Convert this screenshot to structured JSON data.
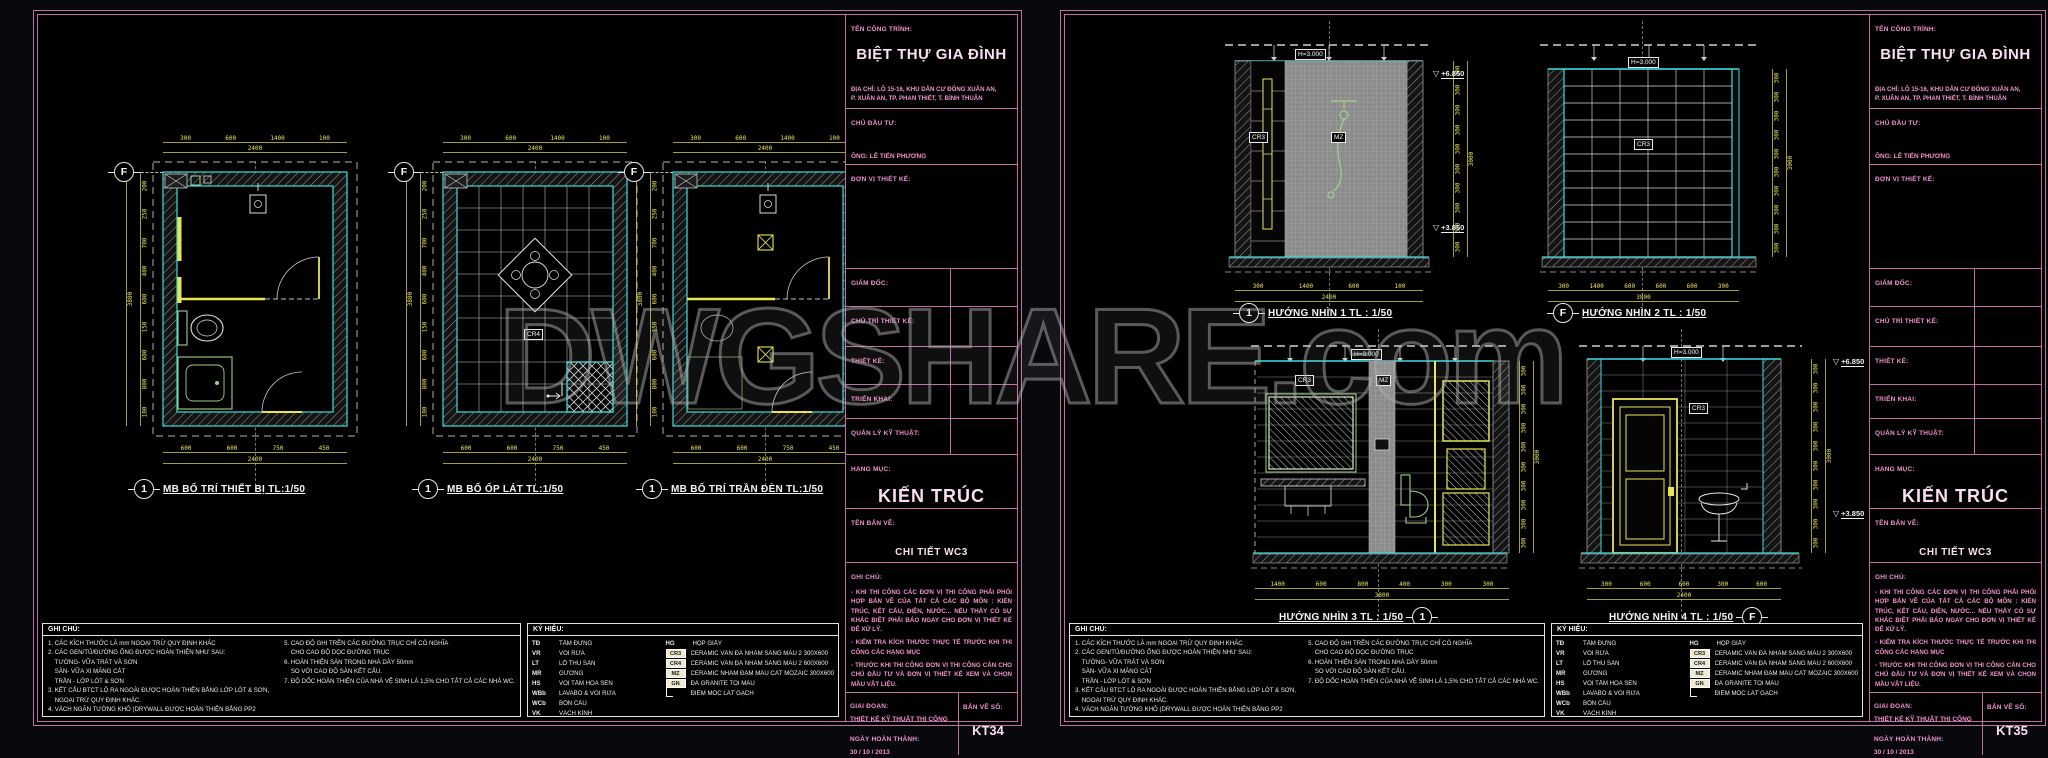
{
  "watermark": {
    "text": "DWGSHARE.com"
  },
  "grid": {
    "f": "F",
    "one": "1"
  },
  "tags": {
    "cr3": "CR3",
    "cr4": "CR4",
    "mz": "MZ",
    "h": "H=3.000"
  },
  "levels": {
    "upper": "+6.850",
    "lower": "+3.850"
  },
  "left_sheet": {
    "plans": [
      {
        "title": "MB BỐ TRÍ THIẾT BỊ TL:1/50"
      },
      {
        "title": "MB BỐ ỐP LÁT TL:1/50"
      },
      {
        "title": "MB BỐ TRÍ TRẦN ĐÈN TL:1/50"
      }
    ],
    "plan_dims": {
      "top": [
        "300",
        "600",
        "1400",
        "100"
      ],
      "top_total": "2400",
      "left": [
        "200",
        "250",
        "700",
        "400",
        "600",
        "150",
        "600",
        "800",
        "100"
      ],
      "left_total": "3800",
      "bottom": [
        "600",
        "600",
        "750",
        "450"
      ],
      "bottom_total": "2400"
    }
  },
  "right_sheet": {
    "elevations": [
      {
        "title": "HƯỚNG NHÌN 1 TL : 1/50",
        "bubble": "1"
      },
      {
        "title": "HƯỚNG NHÌN 2 TL : 1/50",
        "bubble": "F"
      },
      {
        "title": "HƯỚNG NHÌN 3 TL : 1/50",
        "bubble": "1"
      },
      {
        "title": "HƯỚNG NHÌN 4 TL : 1/50",
        "bubble": "F"
      }
    ],
    "elev_dims": {
      "side": [
        "300",
        "300",
        "300",
        "300",
        "300",
        "300",
        "300",
        "300",
        "300",
        "300"
      ],
      "side_total": "3000",
      "e1_bottom": [
        "300",
        "1400",
        "600",
        "100"
      ],
      "e1_total": "2400",
      "e2_bottom": [
        "300",
        "1400",
        "600",
        "600",
        "600",
        "300"
      ],
      "e2_total": "3800",
      "e3_bottom": [
        "1400",
        "600",
        "800",
        "400",
        "300",
        "300"
      ],
      "e3_total": "3800",
      "e4_bottom": [
        "300",
        "600",
        "600",
        "300",
        "600"
      ],
      "e4_total": "2400"
    }
  },
  "tb": {
    "project_label": "TÊN CÔNG TRÌNH:",
    "project_name": "BIỆT THỰ GIA ĐÌNH",
    "address_line1": "ĐỊA CHỈ: LÔ 15-16, KHU DÂN CƯ ĐỒNG XUÂN AN,",
    "address_line2": "P. XUÂN AN, TP. PHAN THIẾT, T. BÌNH THUẬN",
    "investor_label": "CHỦ ĐẦU TƯ:",
    "investor_name": "ÔNG: LÊ TIẾN PHƯƠNG",
    "design_unit_label": "ĐƠN VỊ THIẾT KẾ:",
    "director_label": "GIÁM ĐỐC:",
    "design_lead_label": "CHỦ TRÌ THIẾT KẾ:",
    "designer_label": "THIẾT KẾ:",
    "develop_label": "TRIỂN KHAI:",
    "tech_mgr_label": "QUẢN LÝ KỸ THUẬT:",
    "category_label": "HẠNG MỤC:",
    "category": "KIẾN TRÚC",
    "drawing_name_label": "TÊN BẢN VẼ:",
    "drawing_name": "CHI TIẾT WC3",
    "notes_label": "GHI CHÚ:",
    "note1": "- KHI THI CÔNG CÁC ĐƠN VỊ THI CÔNG PHẢI PHỐI HỢP BẢN VẼ CỦA TẤT CẢ CÁC BỘ MÔN : KIẾN TRÚC, KẾT CẤU, ĐIỆN, NƯỚC... NẾU THẤY CÓ SỰ KHÁC BIỆT PHẢI BÁO NGAY CHO ĐƠN VỊ THIẾT KẾ ĐỂ XỬ LÝ.",
    "note2": "- KIỂM TRA KÍCH THƯỚC THỰC TẾ TRƯỚC KHI THI CÔNG CÁC HẠNG MỤC",
    "note3": "- TRƯỚC KHI THI CÔNG ĐƠN VỊ THI CÔNG CẦN CHO CHỦ ĐẦU TƯ VÀ ĐƠN VỊ THIẾT KẾ XEM VÀ CHỌN MẪU VẬT LIỆU.",
    "phase_label": "GIAI ĐOẠN:",
    "phase": "THIẾT KẾ KỸ THUẬT THI CÔNG",
    "date_label": "NGÀY HOÀN THÀNH:",
    "date": "30 / 10 / 2013",
    "sheet_no_label": "BẢN VẼ SỐ:",
    "sheet_no_left": "KT34",
    "sheet_no_right": "KT35"
  },
  "bottom_notes": {
    "header": "GHI CHÚ:",
    "col1": [
      "1.  CÁC KÍCH THƯỚC LÀ mm NGOẠI TRỪ QUY ĐỊNH KHÁC",
      "2.  CÁC GEN/TỦ/ĐƯỜNG ỐNG ĐƯỢC HOÀN THIỆN NHƯ SAU:",
      "    TƯỜNG-   VỮA TRÁT VÀ SƠN",
      "    SÀN-  VỮA XI MĂNG CÁT",
      "    TRẦN - LỚP LÓT & SƠN",
      "3.  KẾT CẤU BTCT LỘ RA NGOÀI ĐƯỢC HOÀN THIỆN BẰNG LỚP LÓT & SƠN,",
      "    NGOẠI TRỪ QUY ĐỊNH KHÁC.",
      "4.  VÁCH NGĂN TƯỜNG KHÔ (DRYWALL ĐƯỢC HOÀN THIỆN BẰNG  PP2"
    ],
    "col2": [
      "5.  CAO ĐỘ GHI TRÊN CÁC ĐƯỜNG TRỤC CHỈ CÓ NGHĨA",
      "    CHO CAO ĐỘ  DỌC ĐƯỜNG TRỤC",
      "6.  HOÀN THIỆN SÀN TRONG NHÀ DÀY 50mm",
      "    SO VỚI CAO ĐỘ  SÀN KẾT CẤU.",
      "7.  ĐỘ DỐC HOÀN THIỆN CỦA NHÀ VỆ SINH LÀ 1,5% CHO TẤT CẢ CÁC NHÀ WC."
    ],
    "legend_header": "KÝ HIỆU:",
    "legend_left": [
      {
        "code": "TĐ",
        "name": "TẤM ĐỨNG"
      },
      {
        "code": "VR",
        "name": "VÒI RỬA"
      },
      {
        "code": "LT",
        "name": "LỖ THU SÀN"
      },
      {
        "code": "MR",
        "name": "GƯƠNG"
      },
      {
        "code": "HS",
        "name": "VÒI TẮM HOA SEN"
      },
      {
        "code": "WBb",
        "name": "LAVABO & VÒI RỬA"
      },
      {
        "code": "WCb",
        "name": "BỒN CẦU"
      },
      {
        "code": "VK",
        "name": "VÁCH KÍNH"
      }
    ],
    "legend_right": [
      {
        "code": "HG",
        "name": "HỘP GIẤY"
      },
      {
        "code": "CR3",
        "name": "CERAMIC VÂN ĐÁ  NHÁM SÁNG MÀU 2 300X600",
        "cls": "boxed"
      },
      {
        "code": "CR4",
        "name": "CERAMIC VÂN ĐÁ  NHÁM SÁNG MÀU 2 600X600",
        "cls": "boxed"
      },
      {
        "code": "MZ",
        "name": "CERAMIC NHÁM ĐẬM MÀU CÁT MOZAIC  300X600",
        "cls": "boxed"
      },
      {
        "code": "GN",
        "name": "ĐÁ GRANITE TỐI MÀU",
        "cls": "boxed"
      },
      {
        "code": "",
        "name": "ĐIỂM MỐC LÁT GẠCH",
        "cls": "mark"
      }
    ]
  }
}
